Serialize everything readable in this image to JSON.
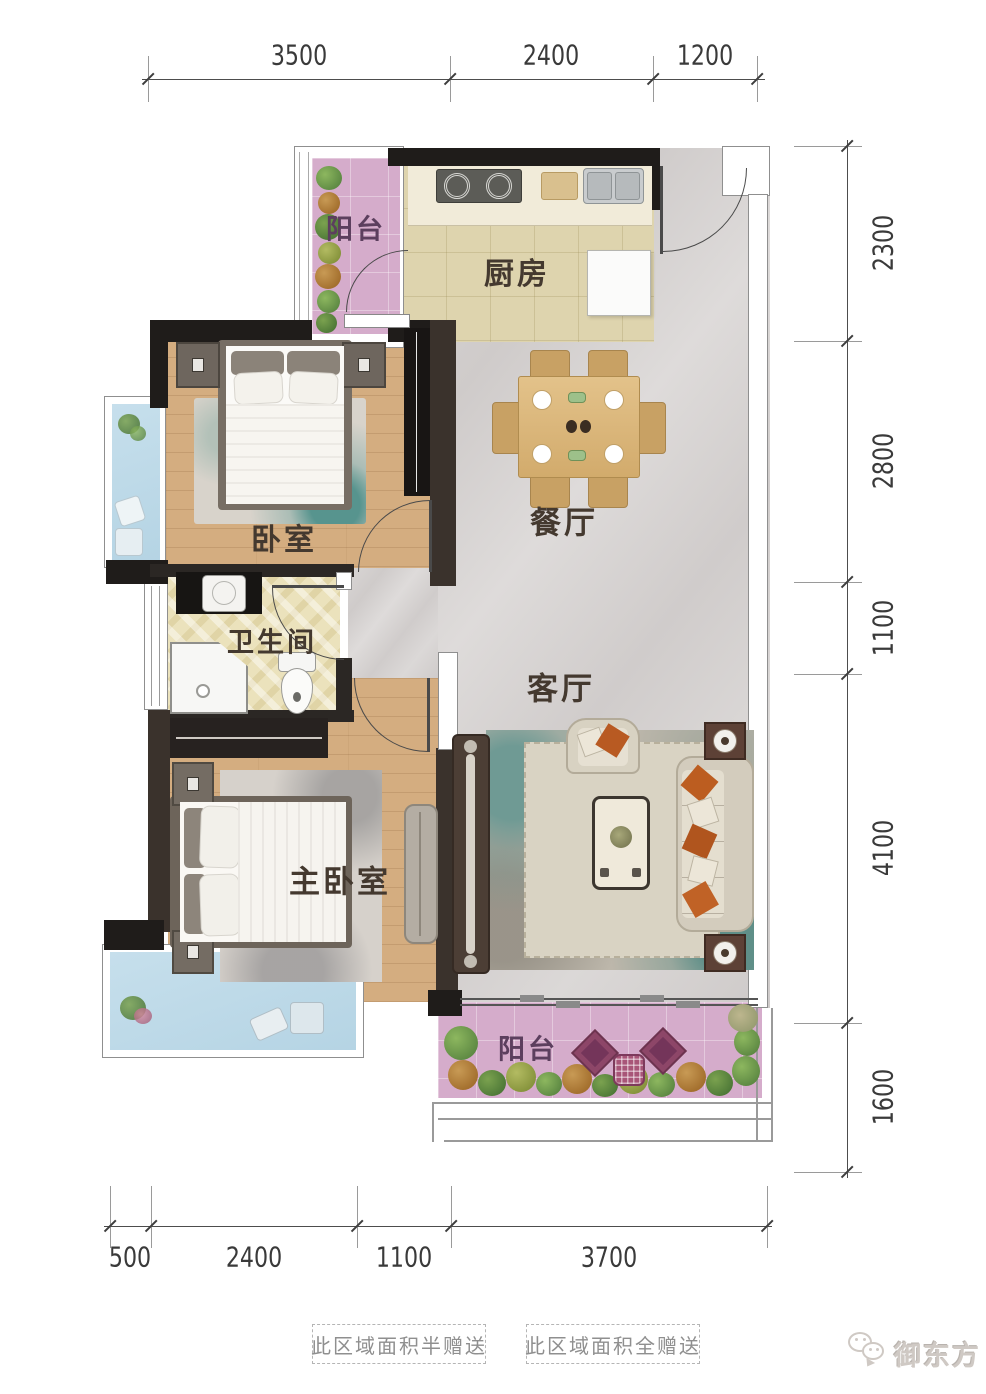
{
  "rooms": {
    "balcony_top": "阳台",
    "kitchen": "厨房",
    "bedroom": "卧室",
    "dining": "餐厅",
    "bathroom": "卫生间",
    "living": "客厅",
    "master_bedroom": "主卧室",
    "balcony_bottom": "阳台"
  },
  "dimensions": {
    "top": [
      "3500",
      "2400",
      "1200"
    ],
    "right": [
      "2300",
      "2800",
      "1100",
      "4100",
      "1600"
    ],
    "bottom": [
      "500",
      "2400",
      "1100",
      "3700"
    ]
  },
  "notes": {
    "half_gift": "此区域面积半赠送",
    "full_gift": "此区域面积全赠送"
  },
  "watermark": "御东方",
  "colors": {
    "wall": "#1f1c1a",
    "wood_floor": "#d4ad80",
    "marble_floor": "#d5d2d1",
    "kitchen_floor": "#ded4ae",
    "bath_floor": "#ebe2bc",
    "balcony_pink": "#d5accb",
    "bay_blue": "#bdd9e8",
    "accent_orange": "#b85a22"
  }
}
